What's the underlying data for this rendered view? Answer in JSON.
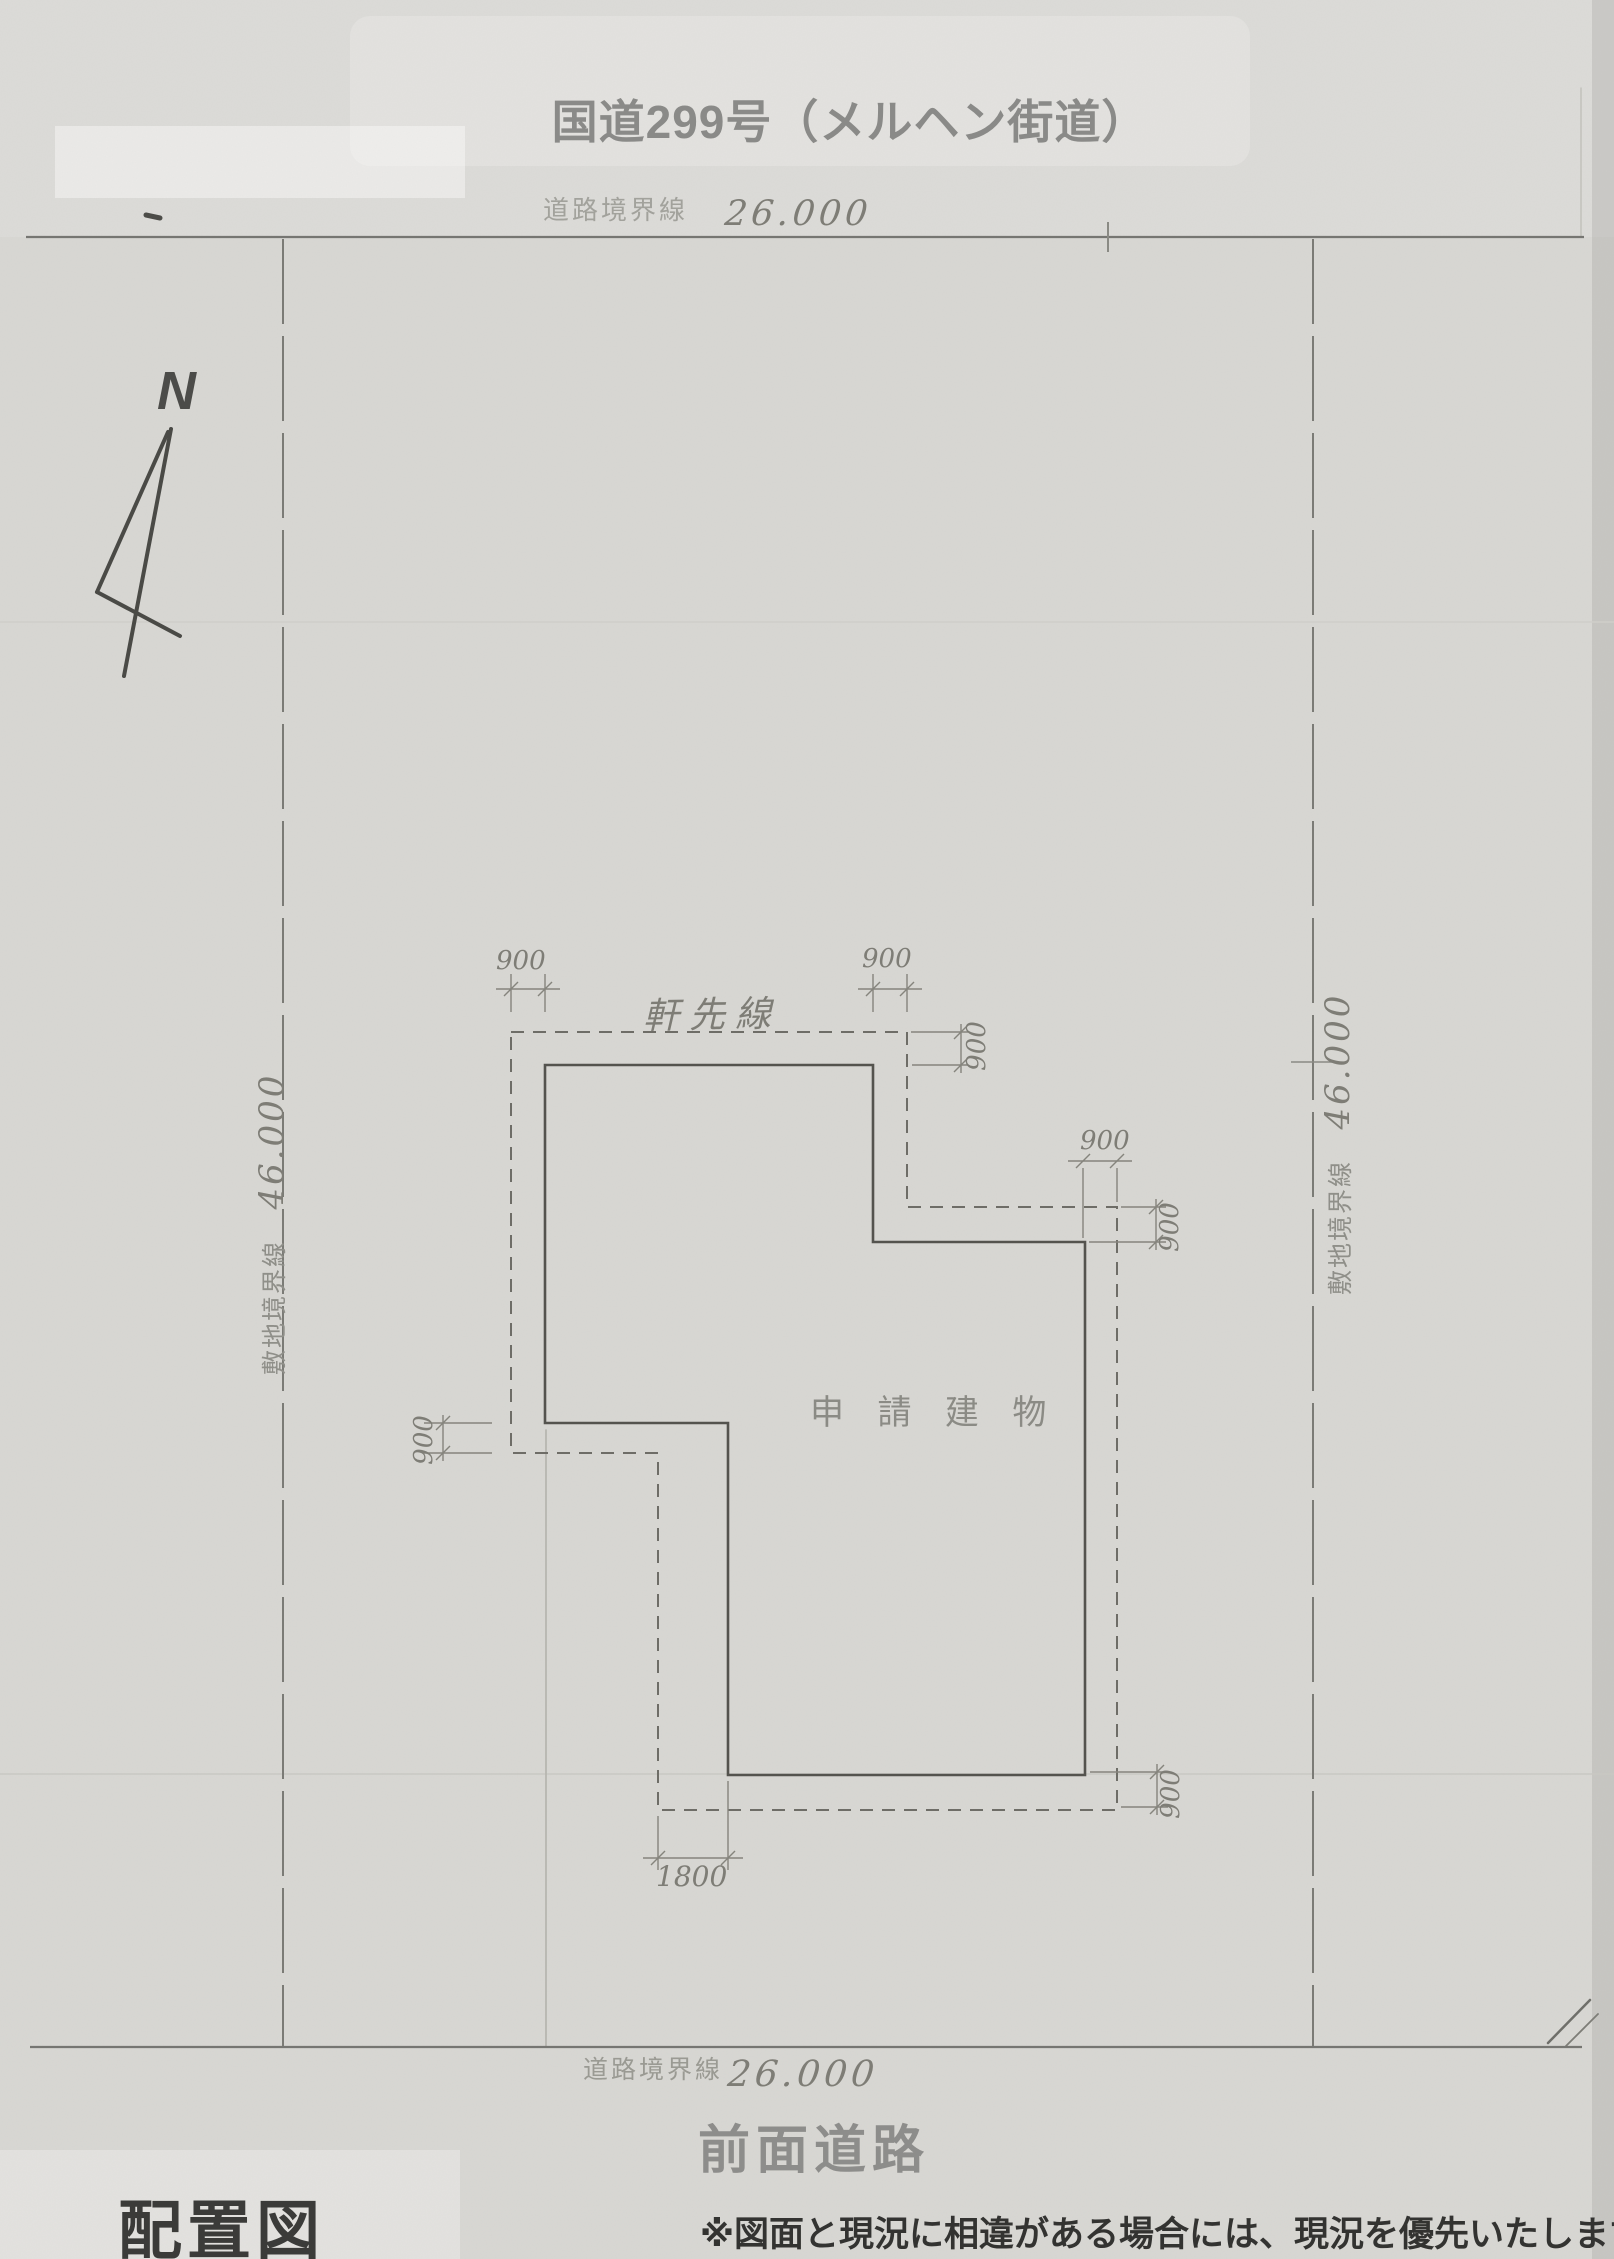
{
  "header": {
    "road_title": "国道299号（メルヘン街道）"
  },
  "compass": {
    "label": "N"
  },
  "boundaries": {
    "top": {
      "label": "道路境界線",
      "value": "26.000"
    },
    "bottom": {
      "label": "道路境界線",
      "value": "26.000"
    },
    "left": {
      "label": "敷地境界線",
      "value": "46.000"
    },
    "right": {
      "label": "敷地境界線",
      "value": "46.000"
    }
  },
  "plan": {
    "eaves_label": "軒先線",
    "building_label": "申 請 建 物",
    "dims": {
      "top_left_eave": "900",
      "top_right_eave": "900",
      "upper_right_eave": "900",
      "notch_width": "900",
      "notch_height": "900",
      "left_step": "900",
      "bottom_width": "1800",
      "bottom_right_eave": "900"
    }
  },
  "footer": {
    "front_road": "前面道路",
    "drawing_title": "配置図",
    "note": "※図面と現況に相違がある場合には、現況を優先いたします"
  },
  "colors": {
    "paper": "#d8d7d3",
    "pencil": "#6e6d67",
    "building_line": "#54534e",
    "annotation_dark": "#3b3b39",
    "annotation_gray": "#8a8a88"
  }
}
